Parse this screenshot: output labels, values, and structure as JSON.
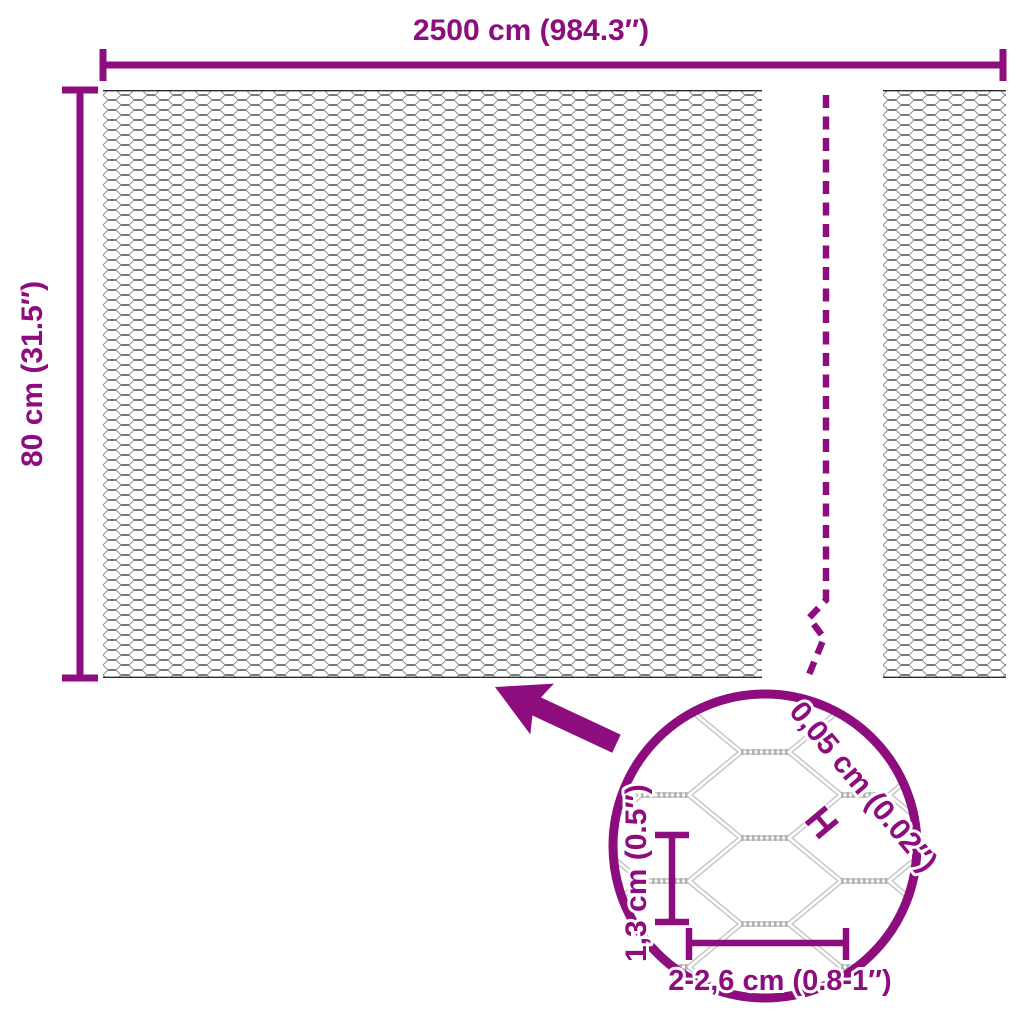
{
  "diagram": {
    "type": "product-dimension-diagram",
    "subject": "hexagonal chicken wire mesh roll",
    "overall": {
      "width_label": "2500 cm (984.3″)",
      "height_label": "80 cm (31.5″)"
    },
    "detail": {
      "wire_thickness_label": "0,05 cm (0.02″)",
      "wire_thickness_marker": "H",
      "mesh_height_label": "1,3 cm (0.5″)",
      "mesh_width_label": "2-2,6 cm (0.8-1″)"
    }
  },
  "icons": {
    "zoom_arrow": "arrow-up-left",
    "detail_circle": "magnifier-detail-circle",
    "break_line": "dashed-break-line"
  },
  "colors": {
    "accent": "#8d0d7f",
    "mesh_dark": "#2b2b2b",
    "mesh_mid": "#8c8c8c",
    "detail_wire": "#c6c6c6",
    "detail_twist": "#b2b2b2",
    "background": "#ffffff"
  }
}
